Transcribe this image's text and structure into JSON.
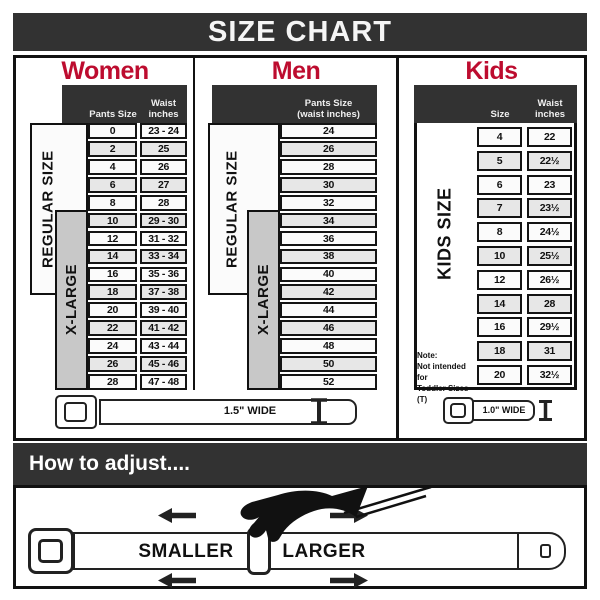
{
  "title": "SIZE CHART",
  "colors": {
    "accent_red": "#bd0c2f",
    "dark_bar": "#323232",
    "row_light": "#fbfbfb",
    "row_gray": "#e7e7e7",
    "xlarge_gray": "#c8c8c8"
  },
  "sections": {
    "women": {
      "title": "Women",
      "pants_header": "Pants Size",
      "waist_header": [
        "Waist",
        "inches"
      ],
      "regular_label": "REGULAR SIZE",
      "xlarge_label": "X-LARGE",
      "rows": [
        {
          "size": "0",
          "waist": "23 - 24"
        },
        {
          "size": "2",
          "waist": "25"
        },
        {
          "size": "4",
          "waist": "26"
        },
        {
          "size": "6",
          "waist": "27"
        },
        {
          "size": "8",
          "waist": "28"
        },
        {
          "size": "10",
          "waist": "29 - 30"
        },
        {
          "size": "12",
          "waist": "31 - 32"
        },
        {
          "size": "14",
          "waist": "33 - 34"
        },
        {
          "size": "16",
          "waist": "35 - 36"
        },
        {
          "size": "18",
          "waist": "37 - 38"
        },
        {
          "size": "20",
          "waist": "39 - 40"
        },
        {
          "size": "22",
          "waist": "41 - 42"
        },
        {
          "size": "24",
          "waist": "43 - 44"
        },
        {
          "size": "26",
          "waist": "45 - 46"
        },
        {
          "size": "28",
          "waist": "47 - 48"
        }
      ]
    },
    "men": {
      "title": "Men",
      "header_lines": [
        "Pants Size",
        "(waist inches)"
      ],
      "regular_label": "REGULAR SIZE",
      "xlarge_label": "X-LARGE",
      "rows": [
        "24",
        "26",
        "28",
        "30",
        "32",
        "34",
        "36",
        "38",
        "40",
        "42",
        "44",
        "46",
        "48",
        "50",
        "52"
      ]
    },
    "kids": {
      "title": "Kids",
      "size_header": "Size",
      "waist_header": [
        "Waist",
        "inches"
      ],
      "side_label": "KIDS SIZE",
      "note_lines": [
        "Note:",
        "Not intended for",
        "Toddler Sizes (T)"
      ],
      "rows": [
        {
          "size": "4",
          "waist": "22"
        },
        {
          "size": "5",
          "waist": "22½"
        },
        {
          "size": "6",
          "waist": "23"
        },
        {
          "size": "7",
          "waist": "23½"
        },
        {
          "size": "8",
          "waist": "24½"
        },
        {
          "size": "10",
          "waist": "25½"
        },
        {
          "size": "12",
          "waist": "26½"
        },
        {
          "size": "14",
          "waist": "28"
        },
        {
          "size": "16",
          "waist": "29½"
        },
        {
          "size": "18",
          "waist": "31"
        },
        {
          "size": "20",
          "waist": "32½"
        }
      ]
    }
  },
  "belts": {
    "adult_width_label": "1.5\" WIDE",
    "kids_width_label": "1.0\" WIDE"
  },
  "adjust": {
    "bar_title": "How to adjust....",
    "smaller_label": "SMALLER",
    "larger_label": "LARGER"
  }
}
